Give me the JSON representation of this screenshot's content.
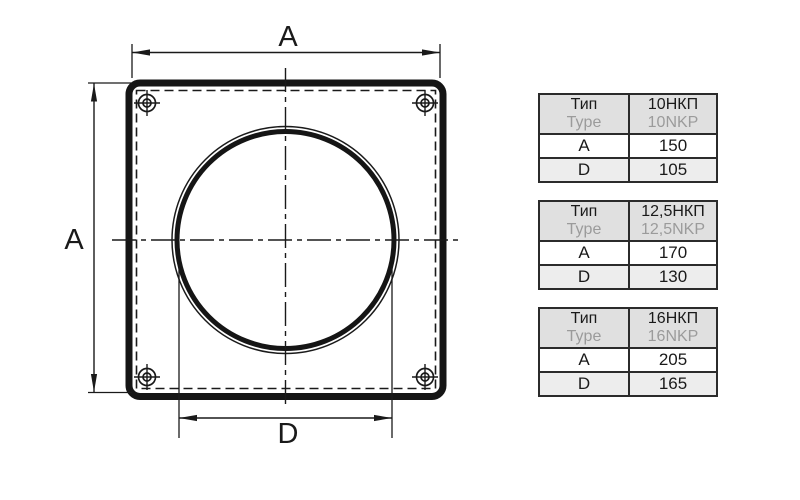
{
  "diagram": {
    "width_label": "A",
    "height_label": "A",
    "diameter_label": "D"
  },
  "tables": [
    {
      "type_label_ru": "Тип",
      "type_label_en": "Type",
      "model_ru": "10НКП",
      "model_en": "10NKP",
      "rows": [
        {
          "param": "A",
          "value": "150"
        },
        {
          "param": "D",
          "value": "105"
        }
      ]
    },
    {
      "type_label_ru": "Тип",
      "type_label_en": "Type",
      "model_ru": "12,5НКП",
      "model_en": "12,5NKP",
      "rows": [
        {
          "param": "A",
          "value": "170"
        },
        {
          "param": "D",
          "value": "130"
        }
      ]
    },
    {
      "type_label_ru": "Тип",
      "type_label_en": "Type",
      "model_ru": "16НКП",
      "model_en": "16NKP",
      "rows": [
        {
          "param": "A",
          "value": "205"
        },
        {
          "param": "D",
          "value": "165"
        }
      ]
    }
  ],
  "colors": {
    "line": "#1a1a1a",
    "table_border": "#2b2b2b",
    "header_bg": "#e0e0e0",
    "alt_row_bg": "#ededed",
    "muted_text": "#9b9b9b"
  },
  "icons": {
    "screw_hole": "crosshair-target-icon"
  }
}
